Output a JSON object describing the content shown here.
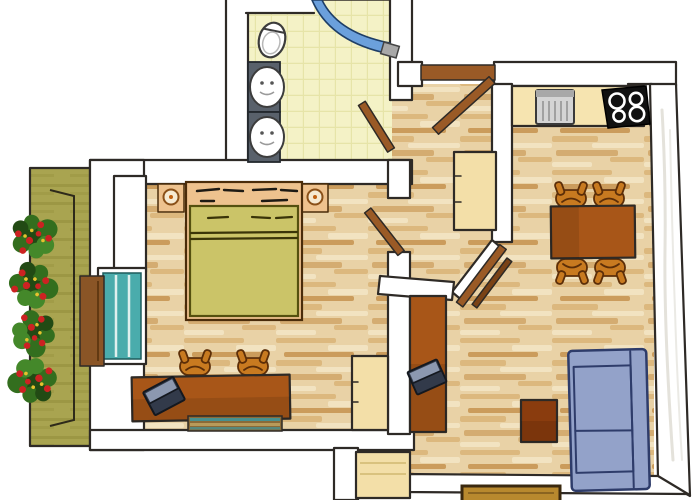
{
  "title": "Hand-drawn apartment floor plan, top-down view",
  "colors": {
    "outline": "#2e2a26",
    "wall": "#ffffff",
    "wall-shade": "#d8d5cc",
    "wood-base": "#e9d2a6",
    "wood-light": "#f2e3c1",
    "wood-mid": "#dcb87e",
    "wood-dark": "#c6934f",
    "tile-base": "#f4f2c6",
    "tile-line": "#e6e4a8",
    "counter": "#f6e4b0",
    "cream": "#f3dfa8",
    "cream-line": "#d9c27e",
    "balcony": "#a9a450",
    "balcony-streak": "#918c3a",
    "foliage": "#336e1e",
    "foliage-dark": "#224a14",
    "foliage-light": "#44882a",
    "flower-red": "#cc2222",
    "flower-yellow": "#e6c22e",
    "blanket": "#cbc468",
    "blanket-line": "#55500f",
    "bedframe": "#eec28e",
    "bedframe-line": "#4a2c0a",
    "furn-wood": "#a85618",
    "furn-wood-deep": "#7e3a0c",
    "table-small": "#8a3c0e",
    "chair": "#c87a20",
    "chair-line": "#5c2e08",
    "door-wood": "#9a5a26",
    "door-wood-dark": "#7a4216",
    "sofa": "#93a2c9",
    "sofa-line": "#2e3c6a",
    "laptop-dark": "#323a4a",
    "laptop-light": "#8c98b0",
    "steel": "#d4d4d4",
    "steel-dark": "#a8a8a8",
    "cooktop": "#101010",
    "burner": "#ffffff",
    "sink-counter": "#59616b",
    "fixture-line": "#3c3c3c",
    "curtain": "#6ba0dc",
    "curtain-line": "#1e3e66",
    "glass": "#4aacac",
    "glass-line": "#1e5c5c",
    "panel-wood": "#8a5526",
    "mat-teal": "#48908e",
    "mat-base": "#8a6a38",
    "mat-sand": "#b89a5a",
    "doormat": "#b8892e",
    "doormat-line": "#3a280e"
  },
  "rooms": [
    {
      "id": "bathroom",
      "floor": "yellow-tiles",
      "items": [
        "toilet",
        "washbasin-upper",
        "washbasin-lower",
        "shower-with-blue-curtain",
        "door-to-hallway"
      ]
    },
    {
      "id": "hallway",
      "floor": "wood-planks",
      "items": [
        "entrance-door",
        "cream-wardrobe",
        "door-to-bedroom",
        "double-door-to-living-room"
      ]
    },
    {
      "id": "kitchen-corner",
      "floor": "wood-planks",
      "items": [
        "counter",
        "steel-sink-unit",
        "black-cooktop-4-burners"
      ]
    },
    {
      "id": "living-dining-room",
      "floor": "wood-planks",
      "items": [
        "dining-table",
        "dining-chair x4",
        "wall-desk",
        "laptop",
        "side-table",
        "blue-sofa-2-seats",
        "niche-closet",
        "doormat"
      ]
    },
    {
      "id": "bedroom",
      "floor": "wood-planks",
      "items": [
        "double-bed",
        "nightstand-left",
        "nightstand-right",
        "corner-niche",
        "balcony-glass-door",
        "desk",
        "desk-chair x2",
        "laptop",
        "striped-rug",
        "corner-wardrobe"
      ]
    },
    {
      "id": "balcony",
      "floor": "green-decking",
      "items": [
        "flower-box x4",
        "wood-panel"
      ]
    }
  ]
}
